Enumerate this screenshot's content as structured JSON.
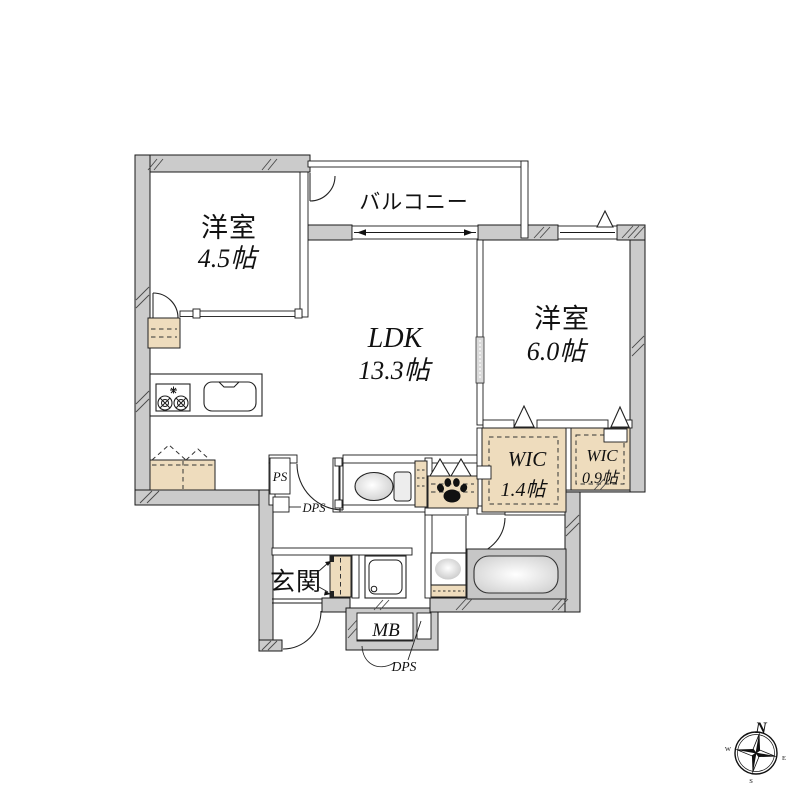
{
  "plan": {
    "rooms": {
      "bedroom1": {
        "name": "洋室",
        "size": "4.5帖"
      },
      "ldk": {
        "name": "LDK",
        "size": "13.3帖"
      },
      "bedroom2": {
        "name": "洋室",
        "size": "6.0帖"
      },
      "balcony": {
        "name": "バルコニー"
      },
      "wic1": {
        "name": "WIC",
        "size": "1.4帖"
      },
      "wic2": {
        "name": "WIC",
        "size": "0.9帖"
      },
      "entrance": {
        "name": "玄関"
      }
    },
    "labels": {
      "ps": "PS",
      "dps_hall": "DPS",
      "dps_bottom": "DPS",
      "mb": "MB"
    },
    "compass": {
      "north": "N",
      "east": "E",
      "south": "S",
      "west": "W"
    },
    "icons": {
      "compass": "compass-rose",
      "paw": "paw-print",
      "stove": "gas-stove",
      "sink": "kitchen-sink",
      "toilet": "toilet",
      "bathtub": "bathtub",
      "washer": "washing-machine-pan",
      "vanity": "washbasin"
    },
    "colors": {
      "wall_fill": "#cbcbcb",
      "storage_fill": "#eedcbd",
      "bath_fill": "#c6c6c6",
      "line": "#1a1a1a",
      "background": "#ffffff"
    }
  }
}
